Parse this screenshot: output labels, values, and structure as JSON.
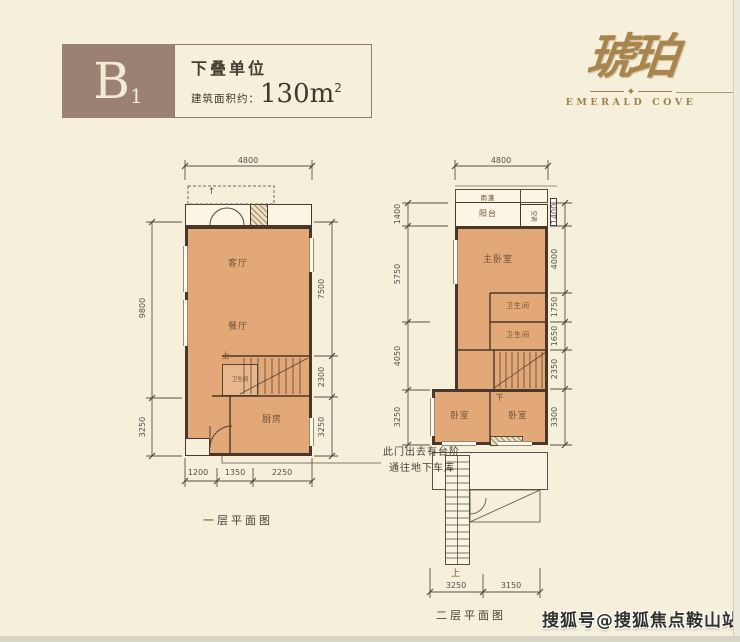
{
  "header": {
    "unit_letter": "B",
    "unit_number": "1",
    "type_label": "下叠单位",
    "area_label": "建筑面积约：",
    "area_value": "130m",
    "area_superscript": "2"
  },
  "logo": {
    "brand_cn": "琥珀",
    "brand_en": "EMERALD COVE",
    "diamond": "◆"
  },
  "floor1": {
    "caption": "一层平面图",
    "labels": {
      "living": "客厅",
      "dining": "餐厅",
      "kitchen": "厨房",
      "bathroom": "卫生间",
      "stairs_up": "上",
      "arrow_up": "↑"
    },
    "dims": {
      "top": "4800",
      "left": [
        "9800",
        "3250"
      ],
      "right": [
        "7500",
        "2300",
        "3250"
      ],
      "bottom": [
        "1200",
        "1350",
        "2250"
      ]
    },
    "note_line1": "此门出去有台阶",
    "note_line2": "通往地下车库"
  },
  "floor2": {
    "caption": "二层平面图",
    "labels": {
      "canopy": "雨蓬",
      "balcony": "阳台",
      "ac": "空调",
      "master_bedroom": "主卧室",
      "bathroom1": "卫生间",
      "bathroom2": "卫生间",
      "stairs_down": "下",
      "bedroom_left": "卧室",
      "bedroom_right": "卧室",
      "stairs_up": "上"
    },
    "dims": {
      "top": "4800",
      "left": [
        "1400",
        "5750",
        "4050",
        "3250"
      ],
      "right": [
        "1400",
        "4000",
        "1750",
        "1650",
        "2350",
        "3300"
      ],
      "bottom": [
        "3250",
        "3150"
      ]
    }
  },
  "watermark": "搜狐号@搜狐焦点鞍山站",
  "colors": {
    "background": "#f6efda",
    "header_block": "#9a8173",
    "header_text": "#f2ead3",
    "room_fill": "#e2a877",
    "wall": "#4a362a",
    "dim_line": "#55514a",
    "logo_gold": "#a8854d",
    "watermark_text": "#33312b"
  }
}
